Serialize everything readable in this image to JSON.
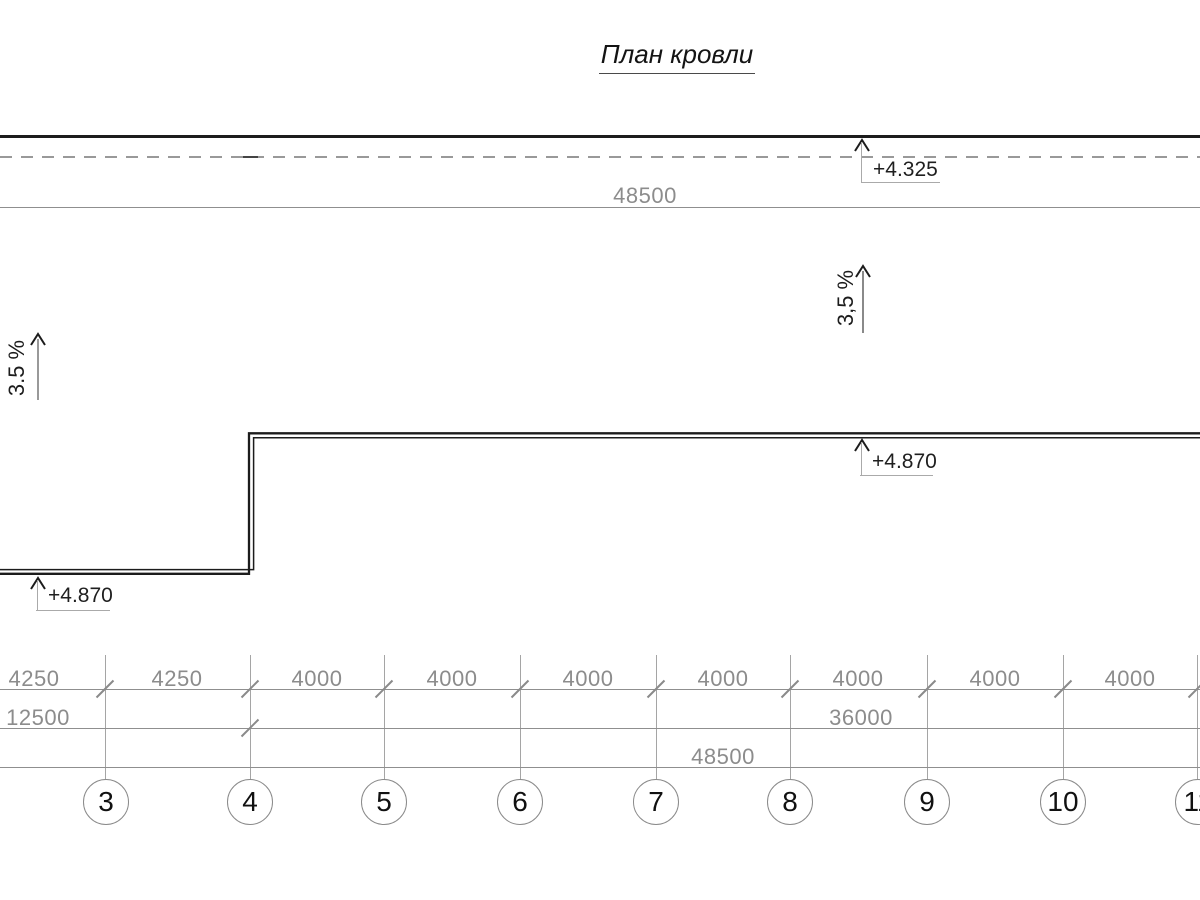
{
  "title": "План кровли",
  "annotations": {
    "eave_elevation": "+4.325",
    "roof_elevation_right": "+4.870",
    "roof_elevation_left": "+4.870",
    "slope_right": "3,5 %",
    "slope_left": "3.5 %"
  },
  "dimensions": {
    "top_overall": "48500",
    "row1": [
      "4250",
      "4250",
      "4000",
      "4000",
      "4000",
      "4000",
      "4000",
      "4000",
      "4000"
    ],
    "row2": [
      "12500",
      "36000"
    ],
    "row3": [
      "48500"
    ]
  },
  "grid_axes": [
    "3",
    "4",
    "5",
    "6",
    "7",
    "8",
    "9",
    "10",
    "11"
  ],
  "colors": {
    "drawing_black": "#1c1c1c",
    "dimension_gray": "#8c8c8c",
    "line_gray": "#999999"
  }
}
